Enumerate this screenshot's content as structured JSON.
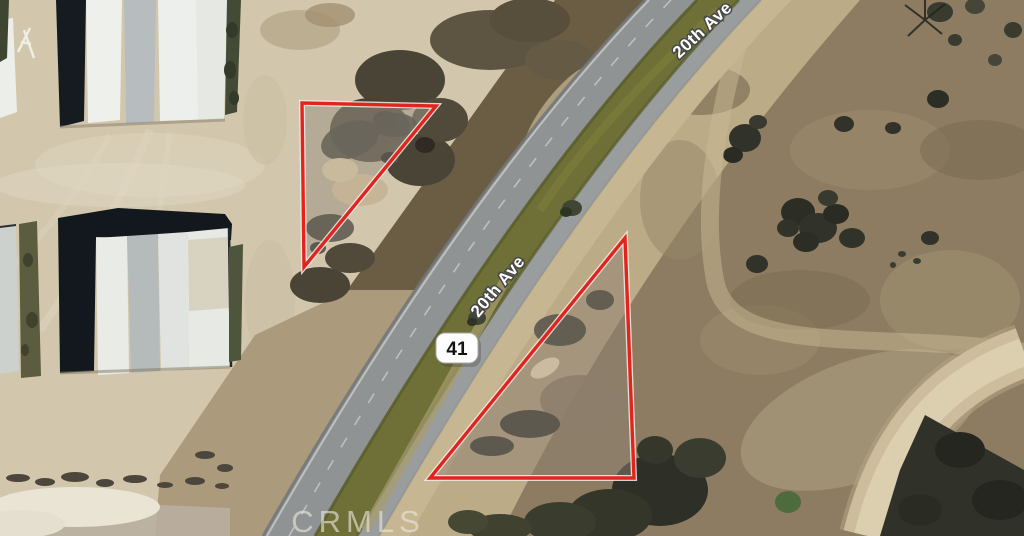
{
  "map": {
    "type": "satellite-aerial",
    "road_labels": [
      {
        "text": "20th Ave"
      },
      {
        "text": "20th Ave"
      }
    ],
    "highway_shield": {
      "label": "41"
    },
    "watermark": {
      "text": "CRMLS"
    },
    "parcels": [
      {
        "name": "parcel-outline-1",
        "shape": "triangle",
        "outline_color": "#e2241f"
      },
      {
        "name": "parcel-outline-2",
        "shape": "triangle",
        "outline_color": "#e2241f"
      }
    ],
    "colors": {
      "parcel_outline": "#e2241f",
      "road_label_fill": "#ffffff",
      "road_label_halo": "#474747",
      "asphalt": "#909394",
      "median_olive": "#6f7038",
      "sand": "#d2c7ad",
      "scrub_field": "#8d7c61"
    }
  }
}
